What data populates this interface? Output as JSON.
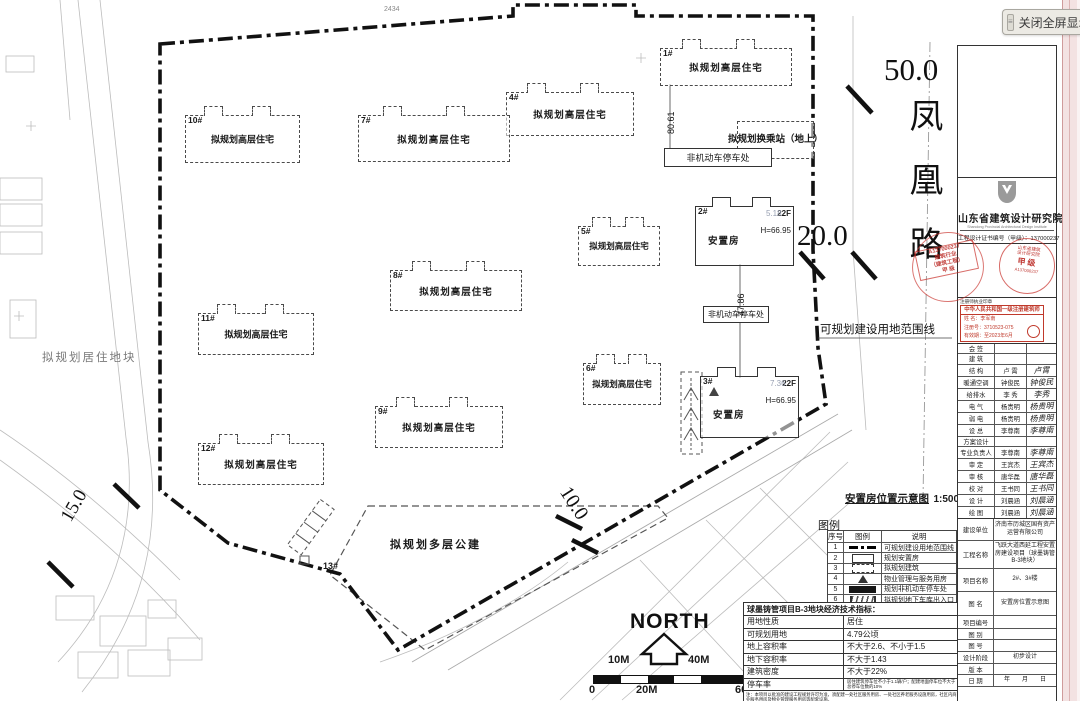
{
  "viewer": {
    "close_label": "关闭全屏显示",
    "grip_glyph": "≡"
  },
  "plan": {
    "road": {
      "name": "凤凰路",
      "width_dim": "50.0",
      "dim_20": "20.0",
      "dim_15": "15.0",
      "dim_10": "10.0"
    },
    "boundary_label": "可规划建设用地范围线",
    "residential_plot_label": "拟规划居住地块",
    "transfer_station_label": "拟规划换乘站（地上）",
    "bike_parking_label": "非机动车停车处",
    "north_label": "NORTH",
    "dims": {
      "d8061": "80.61",
      "d4786": "47.86",
      "top": "2434",
      "d518": "5.18",
      "d736": "7.36"
    },
    "buildings": [
      {
        "no": "1#",
        "label": "拟规划高层住宅"
      },
      {
        "no": "2#",
        "label": "安置房",
        "floors": "22F",
        "height": "H=66.95"
      },
      {
        "no": "3#",
        "label": "安置房",
        "floors": "22F",
        "height": "H=66.95"
      },
      {
        "no": "4#",
        "label": "拟规划高层住宅"
      },
      {
        "no": "5#",
        "label": "拟规划高层住宅"
      },
      {
        "no": "6#",
        "label": "拟规划高层住宅"
      },
      {
        "no": "7#",
        "label": "拟规划高层住宅"
      },
      {
        "no": "8#",
        "label": "拟规划高层住宅"
      },
      {
        "no": "9#",
        "label": "拟规划高层住宅"
      },
      {
        "no": "10#",
        "label": "拟规划高层住宅"
      },
      {
        "no": "11#",
        "label": "拟规划高层住宅"
      },
      {
        "no": "12#",
        "label": "拟规划高层住宅"
      },
      {
        "no": "13#",
        "label": "拟规划多层公建"
      }
    ],
    "diagram_title": "安置房位置示意图",
    "diagram_scale": "1:500",
    "legend_title": "图例",
    "legend_headers": [
      "序号",
      "图例",
      "说明"
    ],
    "legend_rows": [
      {
        "no": "1",
        "sym": "lsym lsym-boundary",
        "desc": "可规划建设用地范围线"
      },
      {
        "no": "2",
        "sym": "lsym lsym-rect",
        "desc": "规划安置房"
      },
      {
        "no": "3",
        "sym": "lsym lsym-dashed",
        "desc": "拟规划建筑"
      },
      {
        "no": "4",
        "sym": "lsym lsym-tri",
        "desc": "物业管理与服务用房"
      },
      {
        "no": "5",
        "sym": "lsym lsym-black",
        "desc": "规划非机动车停车处"
      },
      {
        "no": "6",
        "sym": "lsym lsym-ramp",
        "desc": "拟规划地下车库出入口"
      }
    ],
    "econ_title": "球墨铸管项目B-3地块经济技术指标：",
    "econ_rows": [
      {
        "label": "用地性质",
        "value": "居住"
      },
      {
        "label": "可规划用地",
        "value": "4.79公顷"
      },
      {
        "label": "地上容积率",
        "value": "不大于2.6、不小于1.5"
      },
      {
        "label": "地下容积率",
        "value": "不大于1.43"
      },
      {
        "label": "建筑密度",
        "value": "不大于22%"
      },
      {
        "label": "停车率",
        "value": "居住建筑停车位不小于1.1辆/户；配建地面停车位不大于总停车位数的10%"
      }
    ],
    "econ_note": "注：本项目以批准的建设工程规划许可为准，须配建一处社区服务用房、一处社区养老服务设施用房，社区内商业服务用房及物业管理服务用房等配套设施。",
    "scale_bar": {
      "above": [
        "10M",
        "40M"
      ],
      "below": [
        "0",
        "20M",
        "60M"
      ]
    }
  },
  "titleblock": {
    "institute": "山东省建筑设计研究院",
    "institute_en": "Shandong Provincial Architectural Design Institute",
    "cert": "工程设计证书编号（甲级）：137000237",
    "stampA": {
      "l1": "A137000237",
      "l2": "建筑行业",
      "l3": "（建筑工程）",
      "l4": "甲 级"
    },
    "stampB": {
      "arc1": "山东省建筑",
      "arc2": "设计研究院",
      "mid": "甲级",
      "bot": "A137000237"
    },
    "reg_label": "注册师执业印章",
    "reg_box": {
      "title": "中华人民共和国一级注册建筑师",
      "name": "姓 名：李军南",
      "number": "注册号：3710523-075",
      "valid": "有效期：至2023年6月"
    },
    "sign_rows": [
      {
        "label": "会 签",
        "name": "",
        "sig": ""
      },
      {
        "label": "建 筑",
        "name": "",
        "sig": ""
      },
      {
        "label": "结 构",
        "name": "卢 霄",
        "sig": "卢霄"
      },
      {
        "label": "暖通空调",
        "name": "钟俊民",
        "sig": "钟俊民"
      },
      {
        "label": "给排水",
        "name": "李 秀",
        "sig": "李秀"
      },
      {
        "label": "电 气",
        "name": "杨贵明",
        "sig": "杨贵明"
      },
      {
        "label": "弱 电",
        "name": "杨贵明",
        "sig": "杨贵明"
      },
      {
        "label": "设 总",
        "name": "李尊南",
        "sig": "李尊南"
      },
      {
        "label": "方案设计",
        "name": "",
        "sig": ""
      },
      {
        "label": "专业负责人",
        "name": "李尊南",
        "sig": "李尊南"
      },
      {
        "label": "审 定",
        "name": "王宾杰",
        "sig": "王宾杰"
      },
      {
        "label": "审 核",
        "name": "唐华磊",
        "sig": "唐华磊"
      },
      {
        "label": "校 对",
        "name": "王书同",
        "sig": "王书同"
      },
      {
        "label": "设 计",
        "name": "刘晨涵",
        "sig": "刘晨涵"
      },
      {
        "label": "绘 图",
        "name": "刘晨涵",
        "sig": "刘晨涵"
      }
    ],
    "info_rows": [
      {
        "label": "建设单位",
        "value": "济南市历城区国有资产运营有限公司"
      },
      {
        "label": "工程名称",
        "value": "飞跃大道西延工程安置房建设项目（球墨铸管B-3地块）"
      },
      {
        "label": "项目名称",
        "value": "2#、3#楼"
      },
      {
        "label": "图 名",
        "value": "安置房位置示意图"
      },
      {
        "label": "项目编号",
        "value": ""
      },
      {
        "label": "图 别",
        "value": ""
      },
      {
        "label": "图 号",
        "value": ""
      },
      {
        "label": "设计阶段",
        "value": "初步设计"
      },
      {
        "label": "版 本",
        "value": ""
      },
      {
        "label": "日 期",
        "value": "年　　月　　日"
      }
    ]
  }
}
